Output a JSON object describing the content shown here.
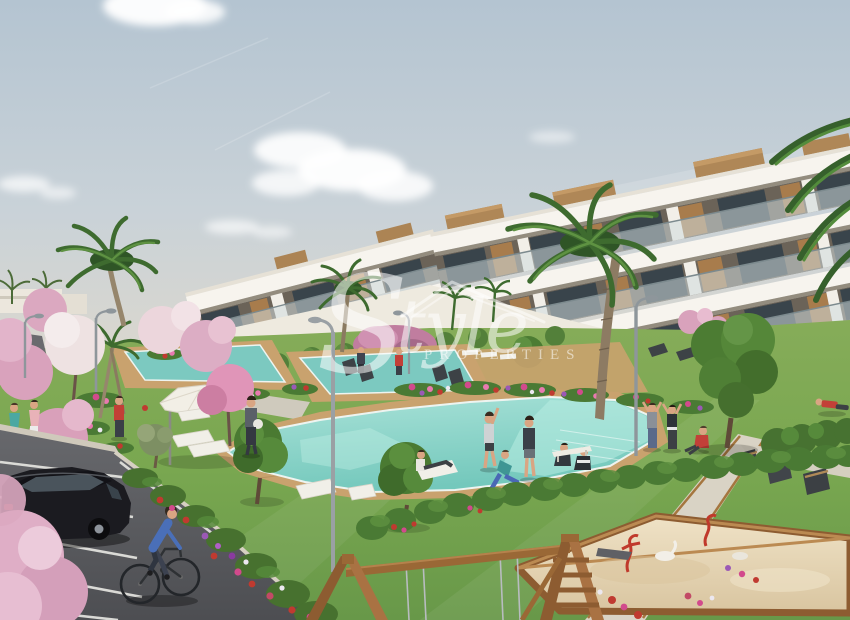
{
  "scene": {
    "type": "3d-architectural-rendering",
    "subject": "modern terraced apartment complex with communal pools, gardens, parking and children's playground"
  },
  "watermark": {
    "brand_script": "Style",
    "brand_caps": "PROPERTIES",
    "logo_roof_icon": "house-roof-outline"
  },
  "palette": {
    "sky_top": "#b7c6d2",
    "sky_horizon": "#e9dfd0",
    "cloud": "#ffffff",
    "building_white": "#f6f3ed",
    "building_shade": "#e3ded4",
    "glass_dark": "#39444b",
    "wood_accent": "#a87c4c",
    "railing_glass": "#cfdadc",
    "arcade_ochre": "#c28a52",
    "lawn": "#79a750",
    "hedge_green": "#4a7a34",
    "foliage": "#4c7c33",
    "palm_green": "#3e6b2f",
    "pink_blossom": "#dcaac2",
    "pool_water": "#7fcfc4",
    "deck_wood": "#c9a26e",
    "road_asphalt": "#5f6063",
    "sand": "#e7d8b9",
    "play_frame_wood": "#9a6836",
    "car_black": "#1b1b20",
    "accent_red": "#c24038",
    "cyclist_blue": "#4a6fb8"
  }
}
